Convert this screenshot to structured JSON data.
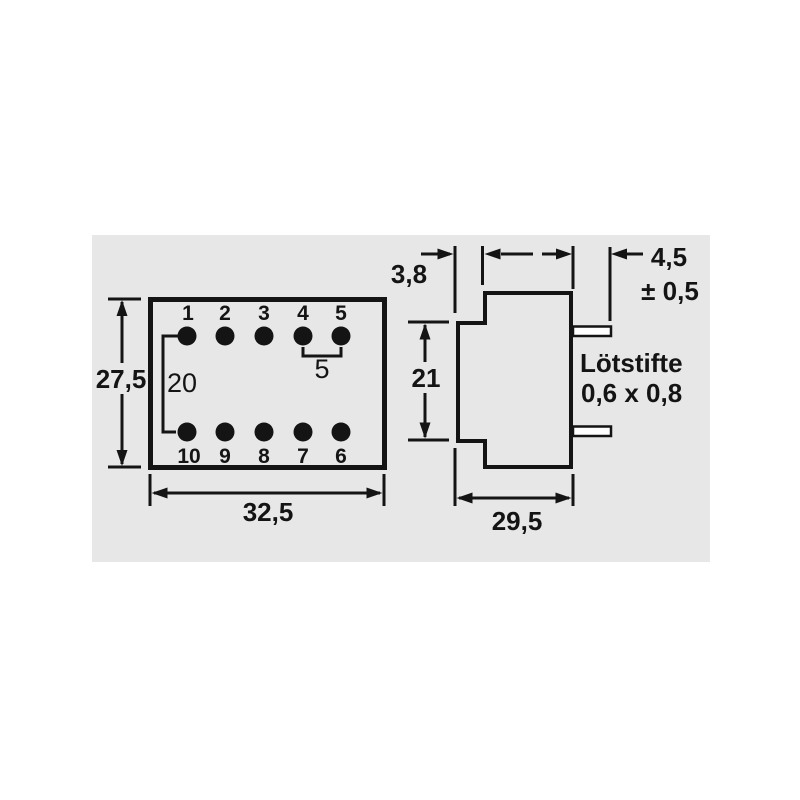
{
  "top_view": {
    "pin_numbers_top": [
      "1",
      "2",
      "3",
      "4",
      "5"
    ],
    "pin_numbers_bottom": [
      "10",
      "9",
      "8",
      "7",
      "6"
    ],
    "width": "32,5",
    "height": "27,5",
    "row_spacing": "20",
    "pin_pitch": "5"
  },
  "side_view": {
    "flange_offset": "3,8",
    "body_height": "21",
    "depth": "29,5",
    "pin_length": "4,5",
    "pin_length_tolerance": "± 0,5",
    "solder_pin_note_line1": "Lötstifte",
    "solder_pin_note_line2": "0,6 x 0,8"
  },
  "colors": {
    "page_background": "#ffffff",
    "panel_background": "#e7e7e7",
    "line": "#141414"
  }
}
